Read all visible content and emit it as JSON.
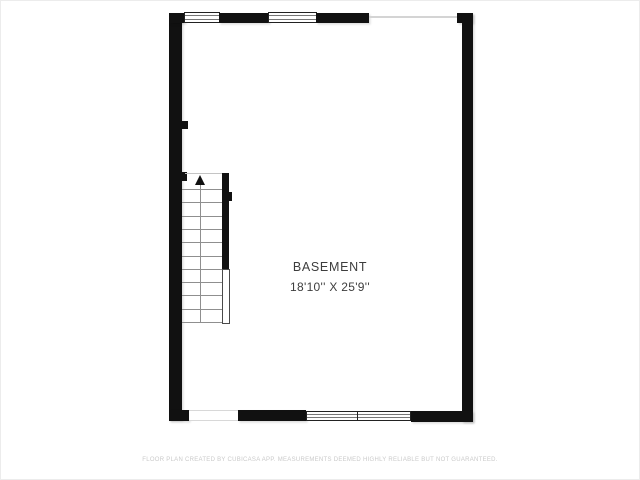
{
  "floor_plan": {
    "room": {
      "name": "BASEMENT",
      "dimensions": "18'10'' X 25'9''"
    },
    "stairs": {
      "direction": "up",
      "tread_count": 11
    },
    "windows": {
      "top_wall_count": 2,
      "bottom_wall_count": 2
    },
    "disclaimer": "FLOOR PLAN CREATED BY CUBICASA APP. MEASUREMENTS DEEMED HIGHLY RELIABLE BUT NOT GUARANTEED.",
    "colors": {
      "wall": "#111111",
      "room_text": "#3d3d3d",
      "disclaimer_text": "#cacaca",
      "background": "#ffffff"
    }
  }
}
